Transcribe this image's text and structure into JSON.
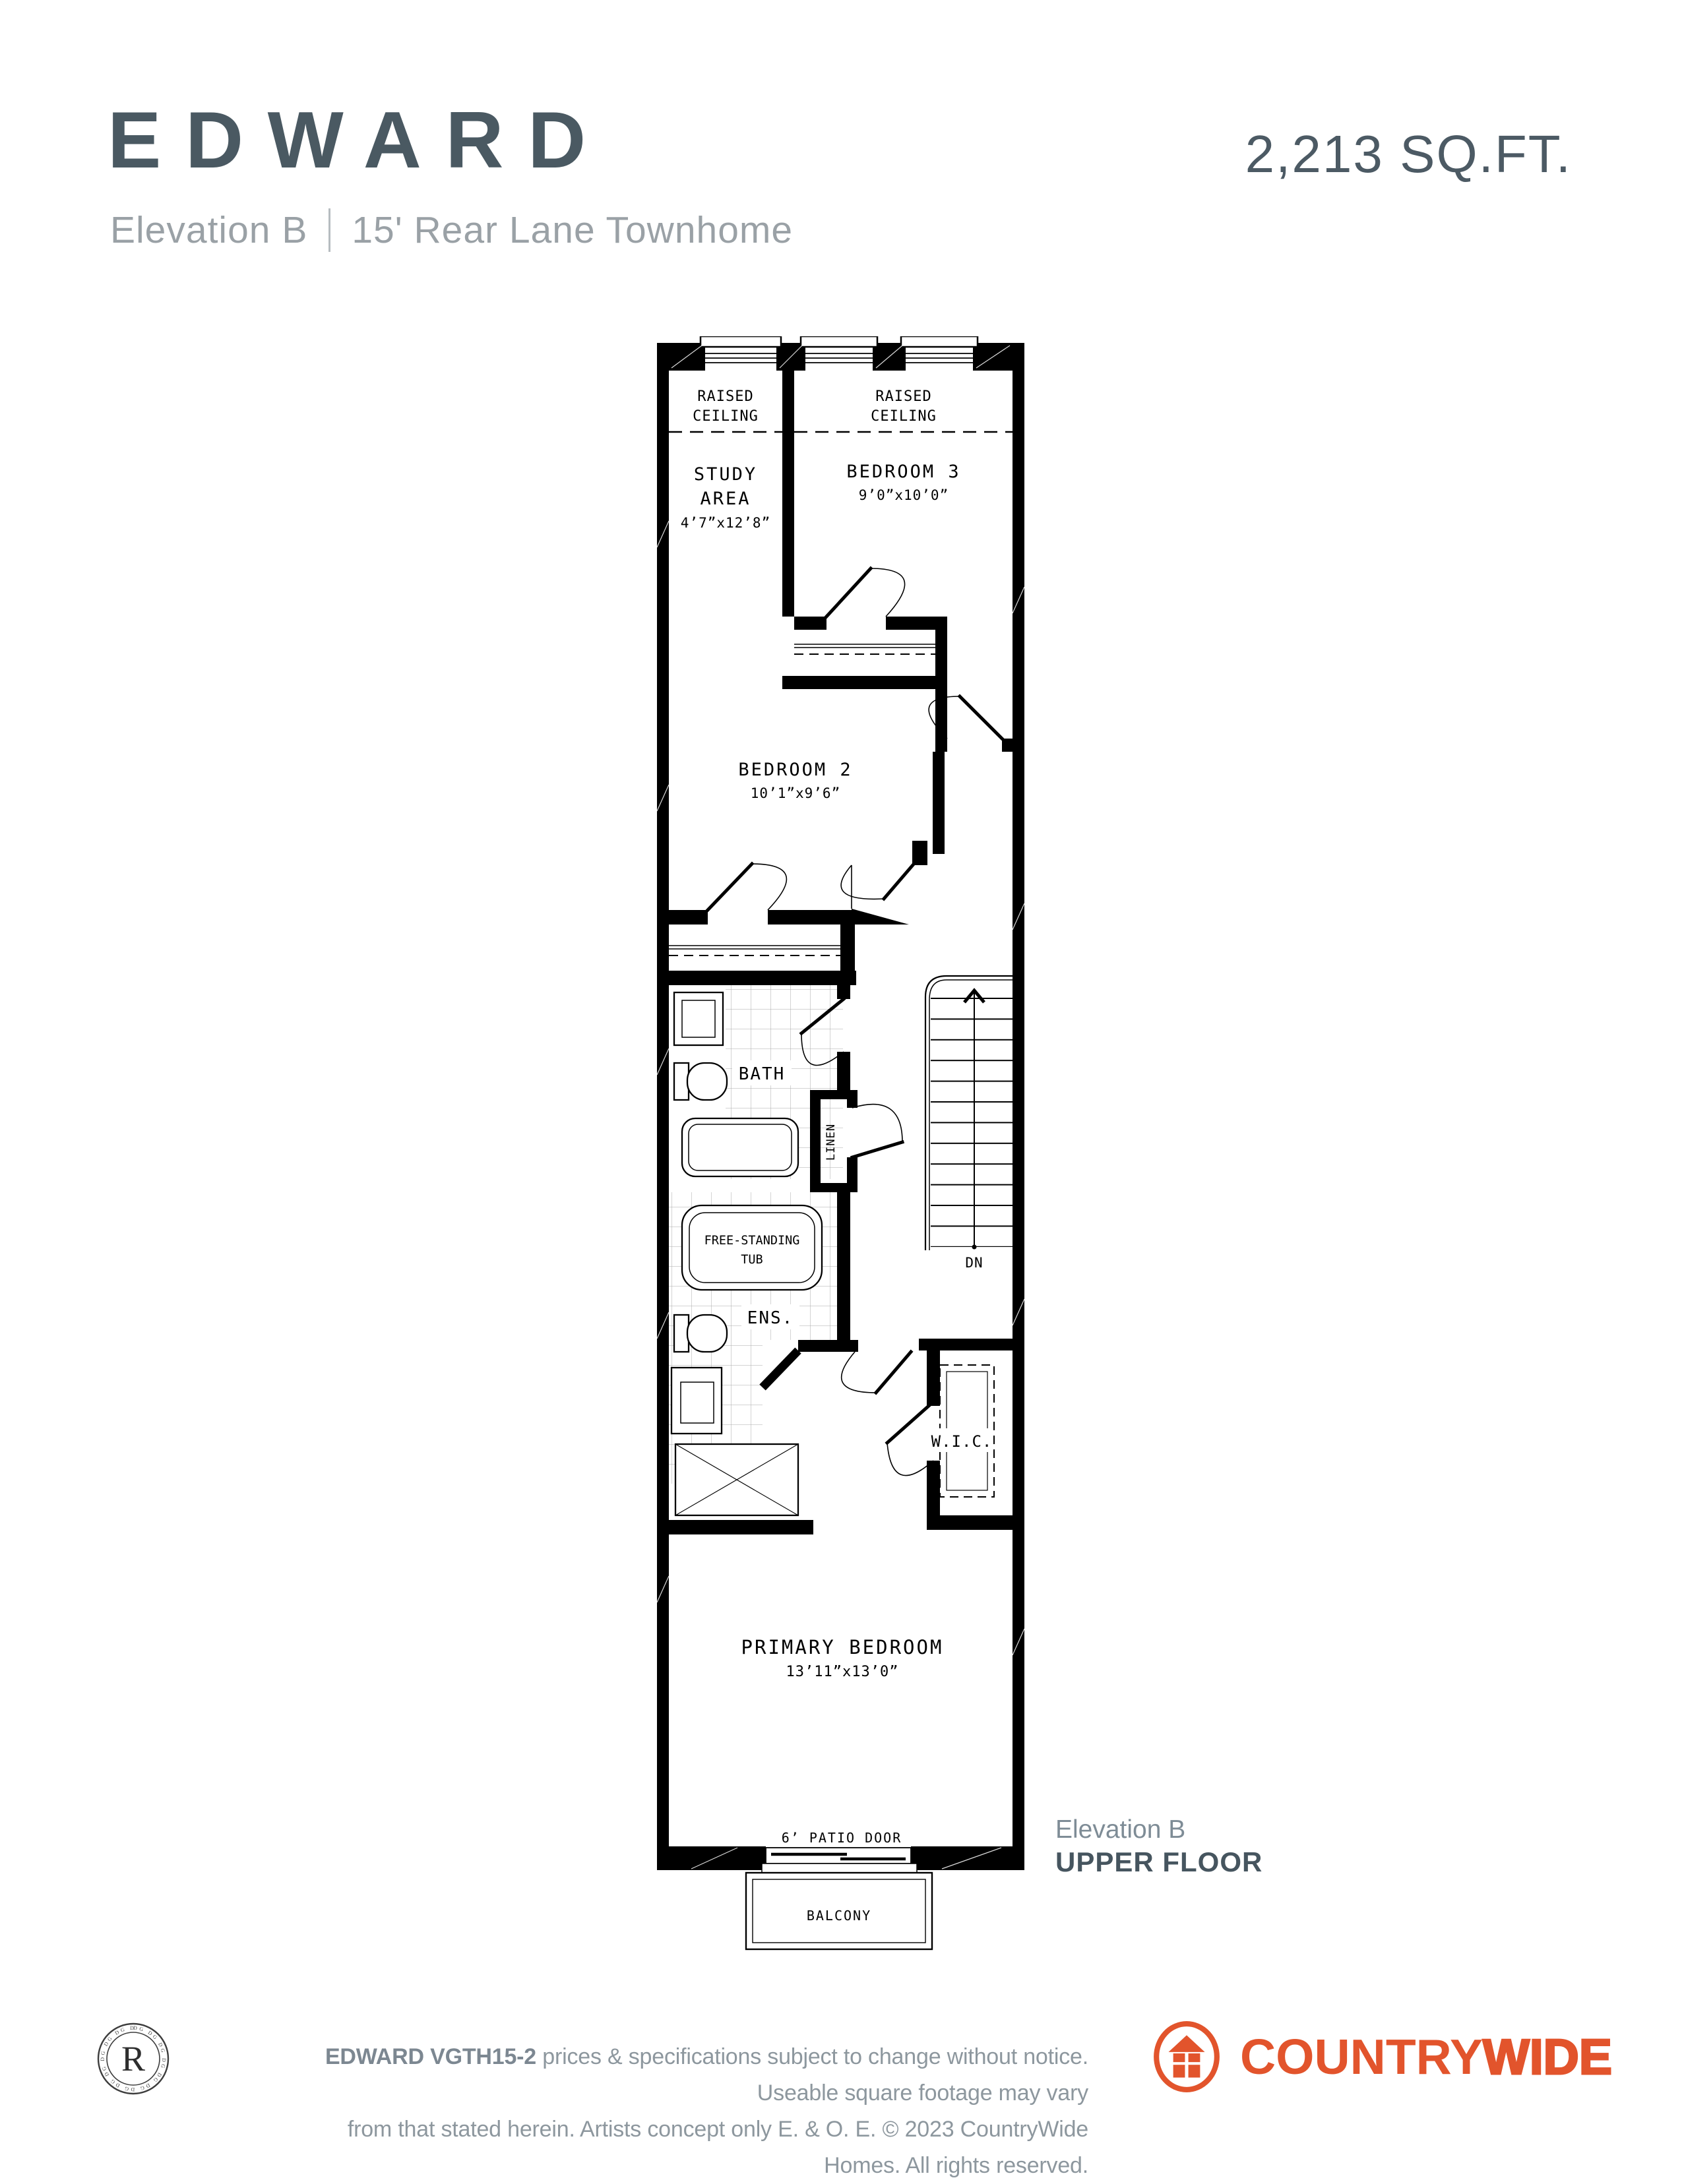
{
  "header": {
    "title": "EDWARD",
    "sqft": "2,213 SQ.FT.",
    "elevation": "Elevation B",
    "subtitle": "15' Rear Lane Townhome"
  },
  "plan": {
    "raised": {
      "l1": "RAISED",
      "l2": "CEILING"
    },
    "study": {
      "l1": "STUDY",
      "l2": "AREA",
      "dims": "4’7”x12’8”"
    },
    "bedroom3": {
      "name": "BEDROOM 3",
      "dims": "9’0”x10’0”"
    },
    "bedroom2": {
      "name": "BEDROOM 2",
      "dims": "10’1”x9’6”"
    },
    "bath": "BATH",
    "linen": "LINEN",
    "ens": "ENS.",
    "fstub": {
      "l1": "FREE-STANDING",
      "l2": "TUB"
    },
    "wic": "W.I.C.",
    "dn": "DN",
    "primary": {
      "name": "PRIMARY BEDROOM",
      "dims": "13’11”x13’0”"
    },
    "patio": "6’ PATIO DOOR",
    "balcony": "BALCONY"
  },
  "caption": {
    "l1": "Elevation B",
    "l2": "UPPER FLOOR"
  },
  "footer": {
    "model": "EDWARD VGTH15-2",
    "d1": "prices & specifications subject to change without notice. Useable square footage may vary",
    "d2": "from that stated herein. Artists concept only E. & O. E. © 2023 CountryWide Homes. All rights reserved.",
    "seal": "R",
    "brand1": "COUNTRY",
    "brand2": "WIDE"
  },
  "colors": {
    "accent": "#e2542c",
    "slate": "#4a5962",
    "subtitle_gray": "#9aa1a6",
    "footer_gray": "#8d979e"
  }
}
